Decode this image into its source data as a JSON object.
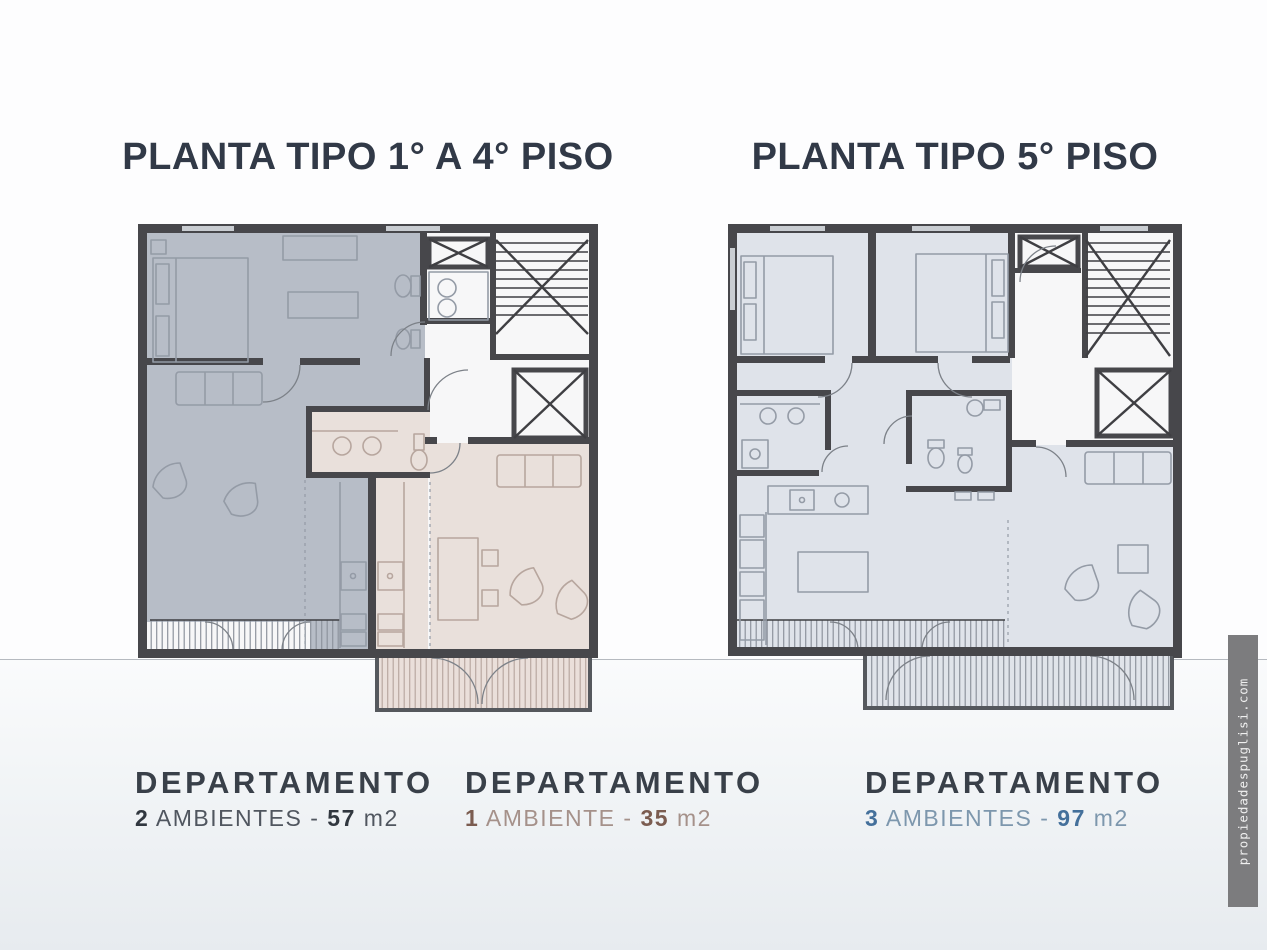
{
  "page": {
    "width": 1267,
    "height": 950,
    "background_top": "#fdfdfe",
    "background_bottom_start": "#fafbfc",
    "background_bottom_end": "#e7ebef",
    "divider_color": "#b6bac0"
  },
  "titles": {
    "left": "PLANTA TIPO 1° A 4° PISO",
    "right": "PLANTA TIPO 5° PISO",
    "color": "#313947"
  },
  "units": [
    {
      "name": "DEPARTAMENTO",
      "count": "2",
      "rooms_label": "AMBIENTES",
      "separator": "-",
      "area": "57",
      "area_unit": "m2",
      "accent_color": "#31373f",
      "muted_color": "#50565f"
    },
    {
      "name": "DEPARTAMENTO",
      "count": "1",
      "rooms_label": "AMBIENTE",
      "separator": "-",
      "area": "35",
      "area_unit": "m2",
      "accent_color": "#7b5c50",
      "muted_color": "#a5918a"
    },
    {
      "name": "DEPARTAMENTO",
      "count": "3",
      "rooms_label": "AMBIENTES",
      "separator": "-",
      "area": "97",
      "area_unit": "m2",
      "accent_color": "#44709b",
      "muted_color": "#7d97ad"
    }
  ],
  "watermark": {
    "text": "propiedadespuglisi.com",
    "background": "#7c7c7e",
    "color": "#f0f0f0"
  },
  "colors": {
    "wall": "#47474b",
    "apt_2amb": "#b7bdc7",
    "apt_1amb": "#e9e0db",
    "apt_3amb": "#dfe3ea",
    "common": "#f7f7f8",
    "furn_cool": "#949ba6",
    "furn_warm": "#b7a69e",
    "hatch_cool": "#8d939d",
    "hatch_warm": "#b9a8a1",
    "door_arc": "#7c8188",
    "window": "#c9cdd2",
    "stair_line": "#3f3f43",
    "title_color": "#313947"
  },
  "icons": {
    "bed-icon": "outlined rectangle with pillows",
    "sofa-icon": "outlined seat rectangle with dividers",
    "armchair-icon": "fan shaped chair outline",
    "dining-table-icon": "rectangle with chair squares",
    "stairs-icon": "parallel tread lines with cross diagonals",
    "elevator-icon": "box with X cross",
    "laundry-icon": "box with two circles",
    "toilet-icon": "ellipse with tank rectangle",
    "sink-icon": "circle on vanity line",
    "stove-icon": "square with dot",
    "closet-icon": "hatched rectangle",
    "balcony-icon": "vertically hatched strip with door swing arcs"
  }
}
